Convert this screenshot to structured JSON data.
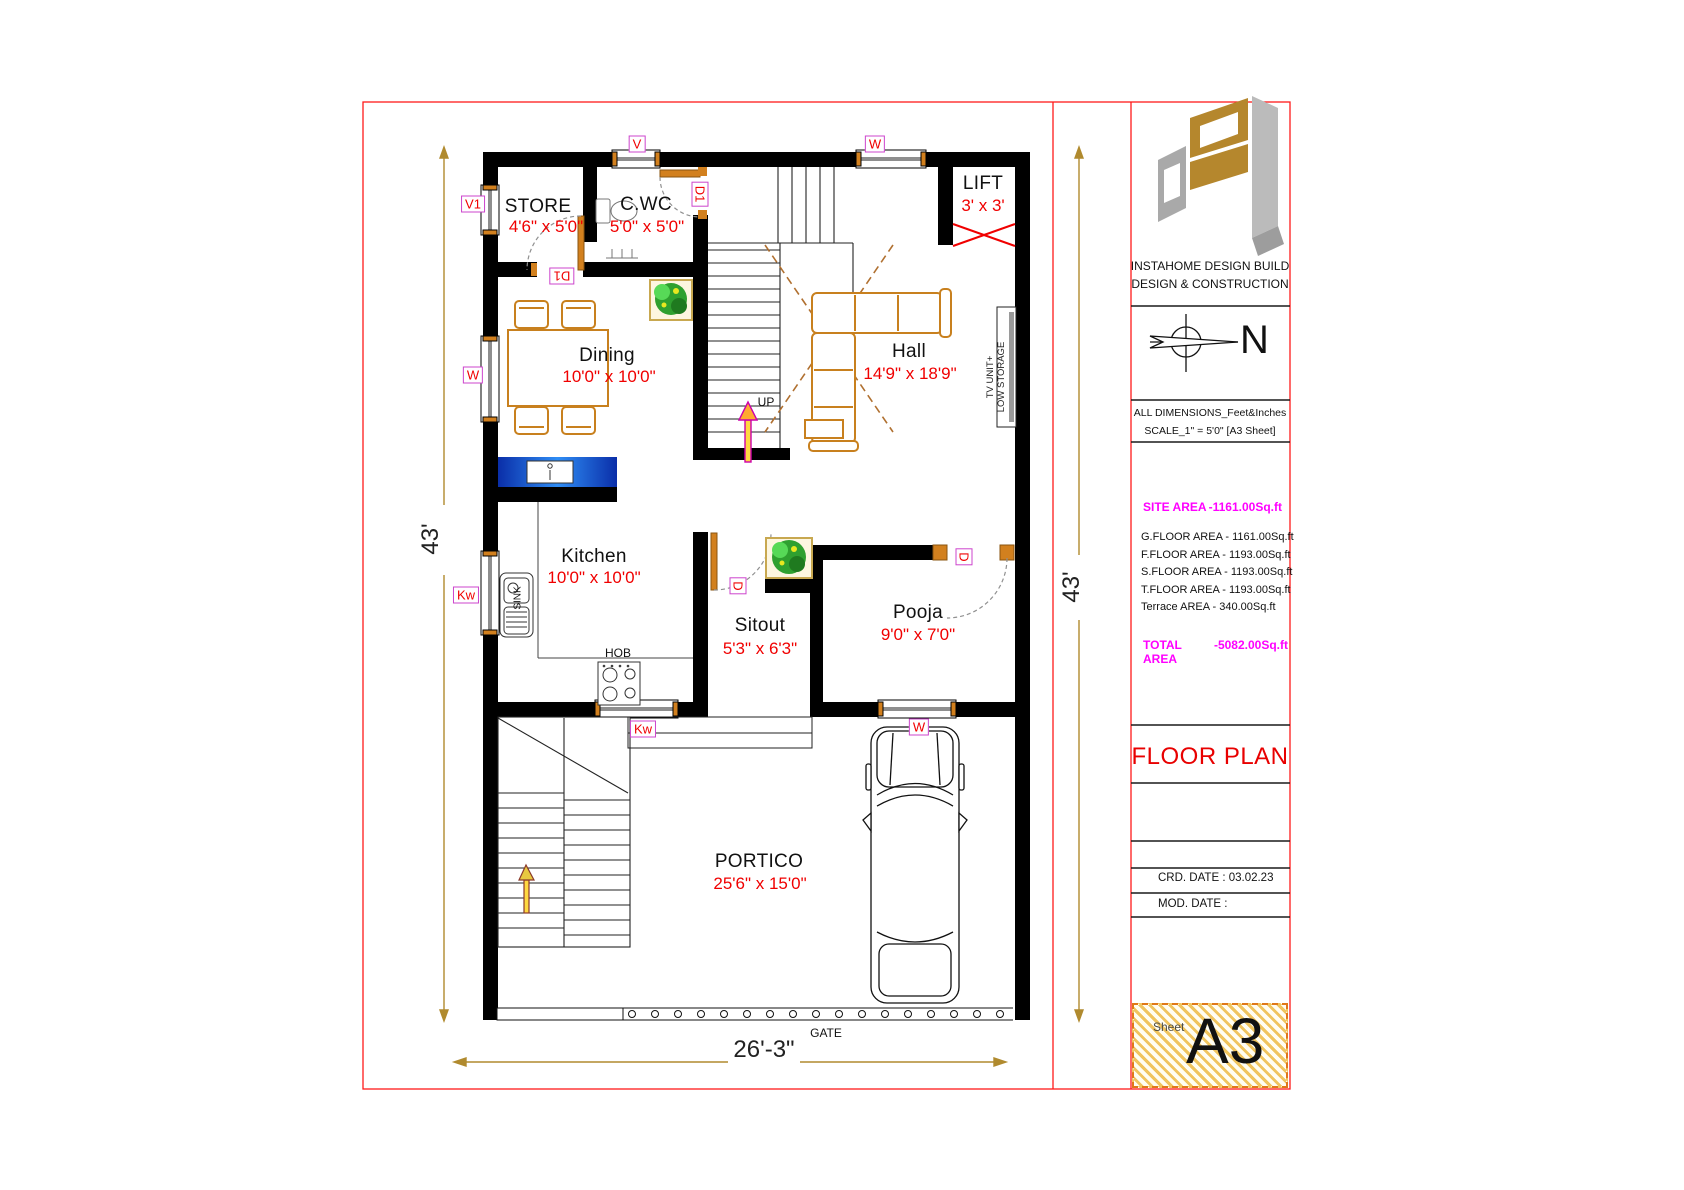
{
  "rooms": {
    "store": {
      "name": "STORE",
      "size": "4'6\" x 5'0\""
    },
    "cwc": {
      "name": "C.WC",
      "size": "5'0\" x 5'0\""
    },
    "lift": {
      "name": "LIFT",
      "size": "3' x 3'"
    },
    "dining": {
      "name": "Dining",
      "size": "10'0\" x 10'0\""
    },
    "hall": {
      "name": "Hall",
      "size": "14'9\" x 18'9\""
    },
    "kitchen": {
      "name": "Kitchen",
      "size": "10'0\" x 10'0\""
    },
    "sitout": {
      "name": "Sitout",
      "size": "5'3\" x 6'3\""
    },
    "pooja": {
      "name": "Pooja",
      "size": "9'0\" x 7'0\""
    },
    "portico": {
      "name": "PORTICO",
      "size": "25'6\" x 15'0\""
    }
  },
  "tags": {
    "v": "V",
    "w_top": "W",
    "v1": "V1",
    "w_left": "W",
    "kw_left": "Kw",
    "d1_cwc": "D1",
    "d1_store": "D1",
    "kw_bottom": "Kw",
    "w_bottom": "W",
    "d_sitout": "D",
    "d_pooja": "D"
  },
  "fixtures": {
    "sink": "SINK",
    "hob": "HOB",
    "up": "UP",
    "gate": "GATE",
    "tv_line1": "TV UNIT+",
    "tv_line2": "LOW STORAGE"
  },
  "dimensions": {
    "left": "43'",
    "right": "43'",
    "bottom": "26'-3\""
  },
  "title_block": {
    "company_line1": "INSTAHOME DESIGN BUILD",
    "company_line2": "DESIGN & CONSTRUCTION",
    "north": "N",
    "note_line1": "ALL DIMENSIONS_Feet&Inches",
    "note_line2": "SCALE_1\" = 5'0\" [A3 Sheet]",
    "site_area_label": "SITE AREA",
    "site_area_value": "-1161.00Sq.ft",
    "areas": [
      "G.FLOOR AREA - 1161.00Sq.ft",
      "F.FLOOR AREA - 1193.00Sq.ft",
      "S.FLOOR AREA - 1193.00Sq.ft",
      "T.FLOOR AREA - 1193.00Sq.ft",
      "Terrace AREA - 340.00Sq.ft"
    ],
    "total_area_label": "TOTAL AREA",
    "total_area_value": "-5082.00Sq.ft",
    "drawing_title": "FLOOR PLAN",
    "crd_date": "CRD. DATE : 03.02.23",
    "mod_date": "MOD. DATE :",
    "sheet_label": "Sheet",
    "sheet_value": "A3"
  },
  "colors": {
    "wall": "#000000",
    "furniture": "#c8801e",
    "dimension": "#b08a2e",
    "red_text": "#f00000",
    "magenta": "#ff00ff",
    "counter_blue": "#1557d8",
    "tag_border": "#cc44cc",
    "frame_red": "#ff1a1a"
  }
}
